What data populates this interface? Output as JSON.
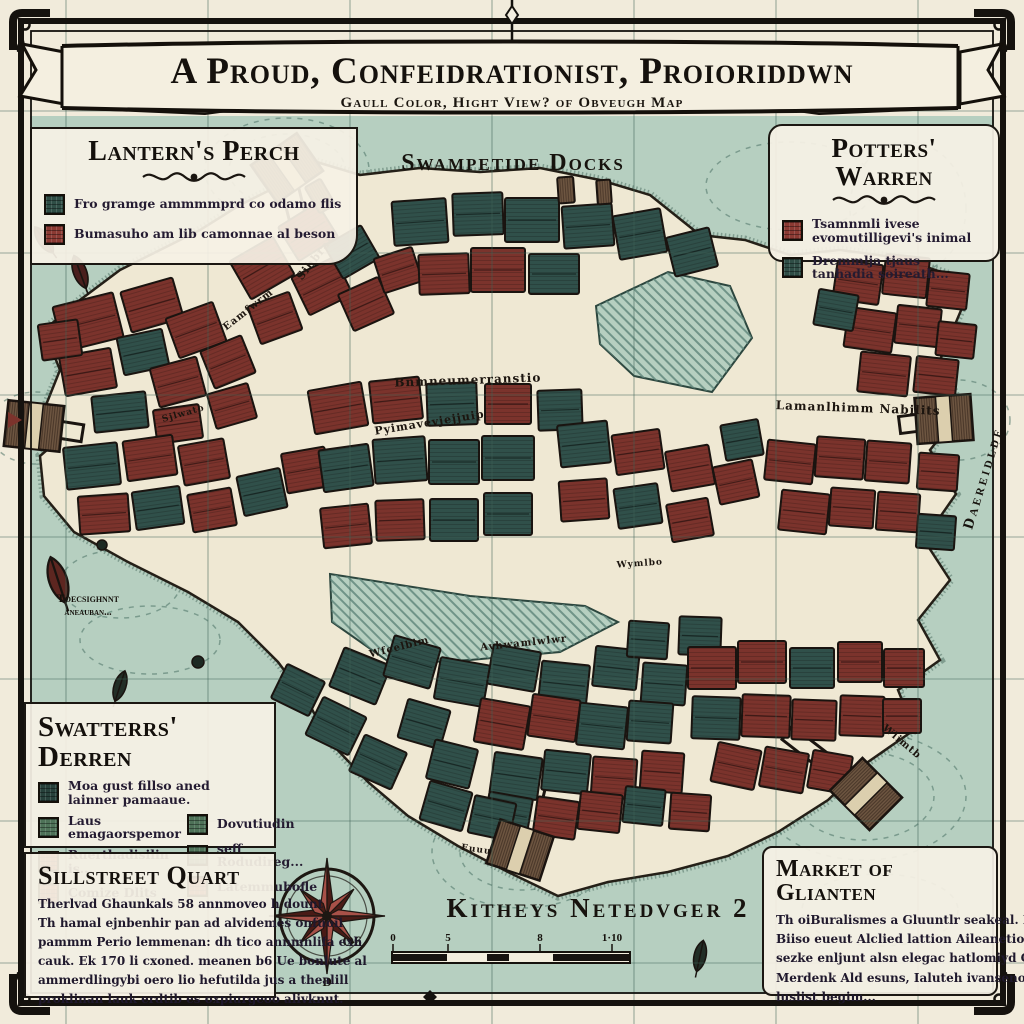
{
  "banner": {
    "title": "A Proud, Confeidrationist, Proioriddwn",
    "subtitle": "Gaull Color, Hight View? of Obveugh Map"
  },
  "boxes": {
    "lanterns": {
      "title": "Lantern's Perch",
      "items": [
        {
          "color": "#2f4e46",
          "text": "Fro gramge ammmmprd co odamo flis"
        },
        {
          "color": "#8c3a33",
          "text": "Bumasuho am lib camonnae al beson"
        }
      ]
    },
    "potters": {
      "title": "Potters' Warren",
      "items": [
        {
          "color": "#8c3a33",
          "text": "Tsamnmli ivese evomutilligevi's inimal"
        },
        {
          "color": "#2f4e46",
          "text": "Dremmlja tjaus tanhadia soireath..."
        }
      ]
    },
    "swatters": {
      "title": "Swatterrs' Derren",
      "lead": {
        "color": "#27413b",
        "text": "Moa gust fillso aned lainner pamaaue."
      },
      "left": [
        {
          "color": "#4e7258",
          "text": "Laus emagaorspemor"
        },
        {
          "color": "#9c4a42",
          "text": "Ruerthadisilin is..."
        },
        {
          "color": "#9c4a42",
          "text": "Comize Dlits"
        }
      ],
      "right": [
        {
          "color": "#4e7258",
          "text": "Dovutiudin"
        },
        {
          "color": "#4e7258",
          "text": "seff Rodudireg..."
        },
        {
          "color": "#9c4a42",
          "text": "Latemmubofle"
        }
      ]
    },
    "sillstreet": {
      "title": "Sillstreet Quart",
      "lines": [
        "Therlvad Ghaunkals 58 annmoveo h dount",
        "Th hamal ejnbenhir pan ad alvidemes onfuoil",
        "pammm Perio lemmenan: dh tico annmnlifa exh",
        "cauk. Ek 170 li cxoned. meanen b6 Ue bonlute al",
        "ammerdlingybi oero lio hefutilda jus a thealill",
        "proklinan lauk erdtib es oxpiurgeoo alivknut."
      ]
    },
    "market": {
      "title": "Market of Glianten",
      "lines": [
        "Th oiBuralismes a Gluuntlr seakeal. N bum",
        "Biiso eueut Alclied lattion Aileanetio oxsumaliee",
        "sezke enljunt alsn elegac hatlomiyd GUA thal",
        "Merdenk Ald esuns, Ialuteh ivanseno ailjise",
        "luslist begim..."
      ]
    }
  },
  "map": {
    "labels": {
      "swampetide": "Swampetide Docks",
      "kitheys": "Kitheys Netedvger 2",
      "daereidlde": "Daereidlde",
      "toeg1": "Toecsighnnt",
      "toeg2": "aneauban...",
      "scale_prefix": "O6",
      "compass_mark": "Ð"
    },
    "streets": [
      {
        "t": "Sihbrat",
        "x": 318,
        "y": 260,
        "r": -52,
        "s": 11
      },
      {
        "t": "Eamfwrm",
        "x": 250,
        "y": 312,
        "r": -38,
        "s": 10
      },
      {
        "t": "Bnmneumerranstio",
        "x": 468,
        "y": 384,
        "r": -2,
        "s": 12
      },
      {
        "t": "Pyimavevjejjuip",
        "x": 430,
        "y": 426,
        "r": -9,
        "s": 11
      },
      {
        "t": "Lamanlhimm Nabilits",
        "x": 858,
        "y": 412,
        "r": 2,
        "s": 12
      },
      {
        "t": "Wfeelbim",
        "x": 400,
        "y": 650,
        "r": -14,
        "s": 10
      },
      {
        "t": "Avhwamlwlwr",
        "x": 524,
        "y": 646,
        "r": -6,
        "s": 10
      },
      {
        "t": "Wymlbo",
        "x": 640,
        "y": 566,
        "r": -4,
        "s": 9
      },
      {
        "t": "Wlimtb",
        "x": 900,
        "y": 744,
        "r": 40,
        "s": 10
      },
      {
        "t": "Sjlwato",
        "x": 184,
        "y": 416,
        "r": -16,
        "s": 9
      },
      {
        "t": "Euuu",
        "x": 476,
        "y": 852,
        "r": 8,
        "s": 9
      }
    ],
    "scale": {
      "ticks": [
        {
          "t": "0",
          "x": 393
        },
        {
          "t": "5",
          "x": 448
        },
        {
          "t": "8",
          "x": 540
        },
        {
          "t": "1·10",
          "x": 612
        }
      ],
      "segments": [
        [
          393,
          54,
          1
        ],
        [
          447,
          40,
          0
        ],
        [
          487,
          22,
          1
        ],
        [
          509,
          44,
          0
        ],
        [
          553,
          76,
          1
        ]
      ]
    },
    "colors": {
      "water": "#b6cfc0",
      "base": "#efe8d3",
      "red": "#7b332c",
      "teal": "#30504a",
      "dock": "#6f5742",
      "outline": "#1a1410",
      "grid": "#3f6357",
      "ink": "#18130e",
      "compass_light": "#a85148",
      "compass_dark": "#4a1b16"
    },
    "grid": {
      "xs": [
        66,
        208,
        350,
        492,
        634,
        776,
        918
      ],
      "ys": [
        111,
        253,
        395,
        537,
        679,
        821,
        963
      ]
    },
    "base_points": "287,170 310,160 360,175 420,168 480,172 540,168 600,180 650,195 700,235 745,240 790,255 840,250 900,258 950,275 962,308 940,360 962,410 930,450 956,494 924,540 950,580 918,620 940,660 898,690 914,730 868,762 828,800 778,832 728,856 668,872 608,882 558,896 508,872 458,846 408,816 368,782 330,742 308,702 278,662 238,622 188,592 128,562 74,532 44,496 40,456 70,430 44,410 60,370 44,330 80,300 120,270 160,250 200,230 240,205 270,190",
    "inlets": [
      "596,306 668,272 730,286 752,338 712,392 634,376 600,344",
      "330,574 470,596 585,606 618,622 560,652 470,660 392,664 332,622"
    ],
    "piers": [
      [
        303,
        240,
        287,
        176
      ],
      [
        74,
        432,
        36,
        426
      ],
      [
        908,
        424,
        948,
        419
      ],
      [
        540,
        774,
        522,
        848
      ],
      [
        794,
        738,
        864,
        792
      ]
    ],
    "docks": [
      {
        "x": 287,
        "y": 168,
        "r": -35
      },
      {
        "x": 34,
        "y": 426,
        "r": 6
      },
      {
        "x": 944,
        "y": 419,
        "r": -4
      },
      {
        "x": 520,
        "y": 850,
        "r": 18
      },
      {
        "x": 866,
        "y": 794,
        "r": 45
      }
    ],
    "leaves": [
      {
        "x": 44,
        "y": 240,
        "r": -35,
        "s": 1,
        "c": "#4a1f1d"
      },
      {
        "x": 80,
        "y": 272,
        "r": -20,
        "s": 1.1,
        "c": "#4a1f1d"
      },
      {
        "x": 58,
        "y": 580,
        "r": -18,
        "s": 1.5,
        "c": "#5d2620"
      },
      {
        "x": 120,
        "y": 686,
        "r": 18,
        "s": 1,
        "c": "#222e26"
      },
      {
        "x": 700,
        "y": 956,
        "r": 12,
        "s": 1,
        "c": "#222e26"
      }
    ],
    "dots": [
      {
        "x": 198,
        "y": 662,
        "r": 6
      },
      {
        "x": 102,
        "y": 545,
        "r": 5
      }
    ],
    "compass": {
      "cx": 327,
      "cy": 916,
      "ring": 47,
      "long": 58,
      "short": 38
    },
    "buildings": [
      [
        88,
        322,
        62,
        46,
        -14,
        0
      ],
      [
        152,
        305,
        54,
        42,
        -16,
        0
      ],
      [
        88,
        372,
        52,
        40,
        -10,
        0
      ],
      [
        143,
        352,
        46,
        38,
        -12,
        1
      ],
      [
        196,
        330,
        50,
        42,
        -20,
        0
      ],
      [
        178,
        382,
        48,
        40,
        -15,
        0
      ],
      [
        228,
        362,
        44,
        40,
        -22,
        0
      ],
      [
        120,
        412,
        54,
        36,
        -6,
        1
      ],
      [
        178,
        424,
        46,
        34,
        -8,
        0
      ],
      [
        232,
        406,
        42,
        36,
        -16,
        0
      ],
      [
        60,
        340,
        40,
        36,
        -8,
        0
      ],
      [
        262,
        268,
        50,
        44,
        -30,
        0
      ],
      [
        308,
        232,
        46,
        40,
        -32,
        0
      ],
      [
        322,
        286,
        48,
        42,
        -26,
        0
      ],
      [
        275,
        318,
        44,
        40,
        -20,
        0
      ],
      [
        352,
        252,
        42,
        38,
        -30,
        1
      ],
      [
        366,
        304,
        44,
        40,
        -24,
        0
      ],
      [
        398,
        270,
        40,
        36,
        -18,
        0
      ],
      [
        420,
        222,
        54,
        44,
        -4,
        1
      ],
      [
        478,
        214,
        50,
        42,
        -2,
        1
      ],
      [
        532,
        220,
        54,
        44,
        0,
        1
      ],
      [
        588,
        226,
        50,
        42,
        -4,
        1
      ],
      [
        444,
        274,
        50,
        40,
        -2,
        0
      ],
      [
        498,
        270,
        54,
        44,
        0,
        0
      ],
      [
        554,
        274,
        50,
        40,
        0,
        1
      ],
      [
        640,
        234,
        48,
        44,
        -10,
        1
      ],
      [
        692,
        252,
        44,
        40,
        -14,
        1
      ],
      [
        320,
        196,
        18,
        30,
        -30,
        2
      ],
      [
        566,
        190,
        16,
        26,
        -4,
        2
      ],
      [
        604,
        192,
        14,
        24,
        -4,
        2
      ],
      [
        858,
        282,
        46,
        40,
        8,
        0
      ],
      [
        906,
        276,
        44,
        40,
        6,
        0
      ],
      [
        948,
        290,
        40,
        36,
        6,
        0
      ],
      [
        870,
        330,
        48,
        40,
        8,
        0
      ],
      [
        918,
        326,
        44,
        38,
        6,
        0
      ],
      [
        956,
        340,
        38,
        34,
        6,
        0
      ],
      [
        884,
        374,
        50,
        40,
        6,
        0
      ],
      [
        936,
        376,
        42,
        36,
        6,
        0
      ],
      [
        836,
        310,
        40,
        36,
        10,
        1
      ],
      [
        92,
        466,
        54,
        42,
        -6,
        1
      ],
      [
        150,
        458,
        50,
        40,
        -8,
        0
      ],
      [
        204,
        462,
        46,
        40,
        -10,
        0
      ],
      [
        104,
        514,
        50,
        38,
        -4,
        0
      ],
      [
        158,
        508,
        48,
        38,
        -8,
        1
      ],
      [
        212,
        510,
        44,
        38,
        -10,
        0
      ],
      [
        262,
        492,
        44,
        40,
        -12,
        1
      ],
      [
        306,
        470,
        44,
        40,
        -10,
        0
      ],
      [
        338,
        408,
        54,
        44,
        -10,
        0
      ],
      [
        396,
        400,
        50,
        42,
        -6,
        0
      ],
      [
        346,
        468,
        50,
        42,
        -8,
        1
      ],
      [
        400,
        460,
        52,
        44,
        -4,
        1
      ],
      [
        452,
        404,
        50,
        42,
        -2,
        1
      ],
      [
        454,
        462,
        50,
        44,
        0,
        1
      ],
      [
        508,
        458,
        52,
        44,
        0,
        1
      ],
      [
        346,
        526,
        48,
        40,
        -6,
        0
      ],
      [
        400,
        520,
        48,
        40,
        -2,
        0
      ],
      [
        454,
        520,
        48,
        42,
        0,
        1
      ],
      [
        508,
        514,
        48,
        42,
        0,
        1
      ],
      [
        508,
        404,
        46,
        40,
        0,
        0
      ],
      [
        560,
        410,
        44,
        40,
        -2,
        1
      ],
      [
        584,
        444,
        50,
        42,
        -6,
        1
      ],
      [
        638,
        452,
        48,
        40,
        -8,
        0
      ],
      [
        584,
        500,
        48,
        40,
        -4,
        0
      ],
      [
        638,
        506,
        44,
        40,
        -8,
        1
      ],
      [
        690,
        468,
        44,
        40,
        -10,
        0
      ],
      [
        690,
        520,
        42,
        38,
        -10,
        0
      ],
      [
        736,
        482,
        40,
        38,
        -12,
        0
      ],
      [
        742,
        440,
        38,
        36,
        -10,
        1
      ],
      [
        790,
        462,
        48,
        40,
        6,
        0
      ],
      [
        840,
        458,
        48,
        40,
        4,
        0
      ],
      [
        888,
        462,
        44,
        40,
        4,
        0
      ],
      [
        804,
        512,
        48,
        40,
        6,
        0
      ],
      [
        852,
        508,
        44,
        38,
        4,
        0
      ],
      [
        898,
        512,
        42,
        38,
        4,
        0
      ],
      [
        938,
        472,
        40,
        36,
        4,
        0
      ],
      [
        936,
        532,
        38,
        34,
        4,
        1
      ],
      [
        360,
        676,
        50,
        42,
        22,
        1
      ],
      [
        412,
        662,
        48,
        42,
        16,
        1
      ],
      [
        462,
        682,
        50,
        42,
        10,
        1
      ],
      [
        514,
        668,
        48,
        40,
        10,
        1
      ],
      [
        564,
        684,
        48,
        42,
        6,
        1
      ],
      [
        616,
        668,
        44,
        40,
        6,
        1
      ],
      [
        664,
        684,
        44,
        40,
        4,
        1
      ],
      [
        648,
        640,
        40,
        36,
        4,
        1
      ],
      [
        700,
        636,
        42,
        38,
        2,
        1
      ],
      [
        336,
        726,
        48,
        42,
        26,
        1
      ],
      [
        378,
        762,
        46,
        40,
        24,
        1
      ],
      [
        424,
        724,
        44,
        40,
        16,
        1
      ],
      [
        452,
        764,
        44,
        40,
        14,
        1
      ],
      [
        298,
        690,
        42,
        38,
        26,
        1
      ],
      [
        502,
        724,
        50,
        44,
        10,
        0
      ],
      [
        554,
        718,
        48,
        42,
        8,
        0
      ],
      [
        602,
        726,
        48,
        42,
        6,
        1
      ],
      [
        650,
        722,
        44,
        40,
        4,
        1
      ],
      [
        516,
        776,
        48,
        42,
        8,
        1
      ],
      [
        566,
        772,
        46,
        40,
        6,
        1
      ],
      [
        614,
        778,
        44,
        40,
        4,
        0
      ],
      [
        662,
        772,
        42,
        40,
        4,
        0
      ],
      [
        508,
        814,
        44,
        38,
        10,
        1
      ],
      [
        556,
        818,
        42,
        38,
        8,
        0
      ],
      [
        712,
        668,
        48,
        42,
        0,
        0
      ],
      [
        762,
        662,
        48,
        42,
        0,
        0
      ],
      [
        812,
        668,
        44,
        40,
        0,
        1
      ],
      [
        860,
        662,
        44,
        40,
        0,
        0
      ],
      [
        904,
        668,
        40,
        38,
        0,
        0
      ],
      [
        716,
        718,
        48,
        42,
        2,
        1
      ],
      [
        766,
        716,
        48,
        42,
        2,
        0
      ],
      [
        814,
        720,
        44,
        40,
        2,
        0
      ],
      [
        862,
        716,
        44,
        40,
        2,
        0
      ],
      [
        736,
        766,
        44,
        40,
        12,
        0
      ],
      [
        784,
        770,
        44,
        40,
        10,
        0
      ],
      [
        830,
        772,
        40,
        38,
        10,
        0
      ],
      [
        902,
        716,
        38,
        34,
        0,
        0
      ],
      [
        446,
        806,
        44,
        40,
        16,
        1
      ],
      [
        492,
        818,
        42,
        38,
        12,
        1
      ],
      [
        600,
        812,
        42,
        38,
        6,
        0
      ],
      [
        644,
        806,
        40,
        36,
        6,
        1
      ],
      [
        690,
        812,
        40,
        36,
        4,
        0
      ]
    ]
  }
}
